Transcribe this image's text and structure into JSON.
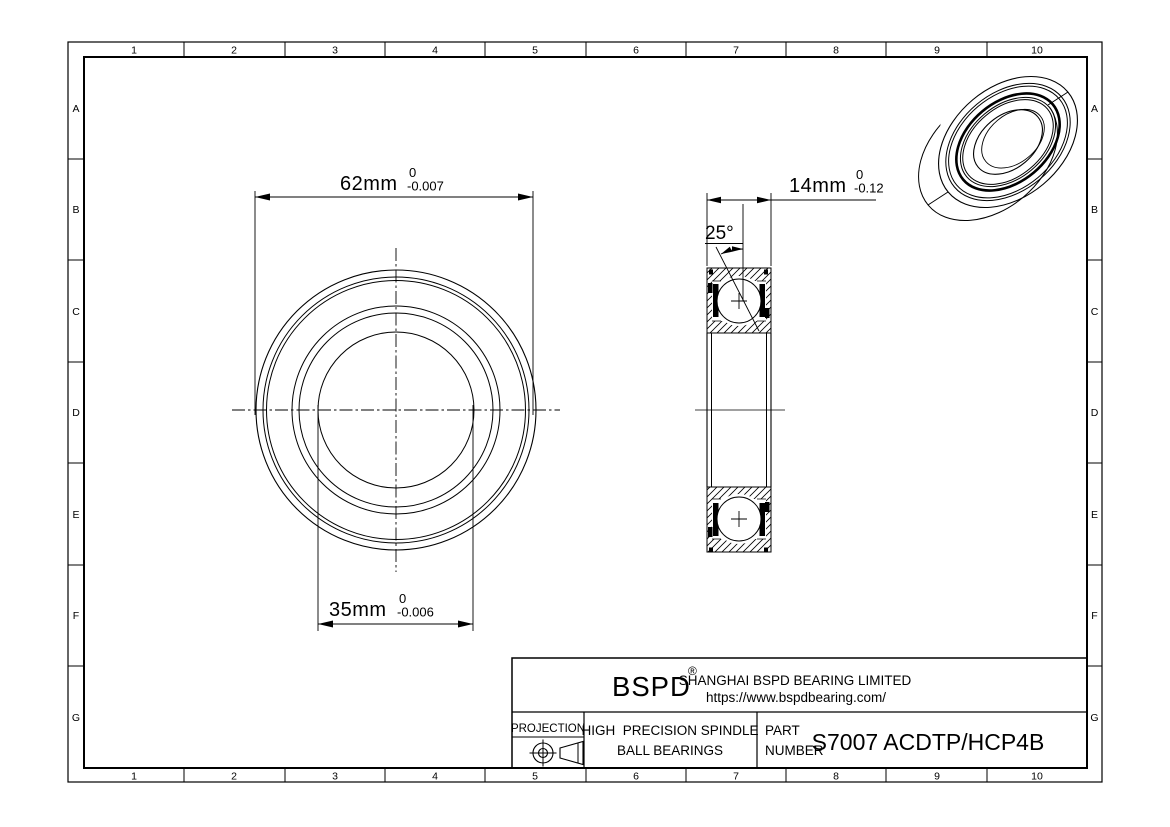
{
  "page": {
    "background": "#ffffff",
    "line_color": "#000000"
  },
  "grid": {
    "columns": [
      "1",
      "2",
      "3",
      "4",
      "5",
      "6",
      "7",
      "8",
      "9",
      "10"
    ],
    "rows": [
      "A",
      "B",
      "C",
      "D",
      "E",
      "F",
      "G"
    ]
  },
  "front_view": {
    "outer_dim": {
      "value": "62mm",
      "tol_upper": "0",
      "tol_lower": "-0.007"
    },
    "bore_dim": {
      "value": "35mm",
      "tol_upper": "0",
      "tol_lower": "-0.006"
    }
  },
  "section_view": {
    "width_dim": {
      "value": "14mm",
      "tol_upper": "0",
      "tol_lower": "-0.12"
    },
    "contact_angle": "25°"
  },
  "title_block": {
    "brand": "BSPD",
    "registered_mark": "®",
    "company": "SHANGHAI BSPD BEARING LIMITED",
    "website": "https://www.bspdbearing.com/",
    "projection_label": "PROJECTION",
    "product_line1": "HIGH  PRECISION SPINDLE",
    "product_line2": "BALL BEARINGS",
    "part_label_line1": "PART",
    "part_label_line2": "NUMBER",
    "part_number": "S7007 ACDTP/HCP4B"
  }
}
